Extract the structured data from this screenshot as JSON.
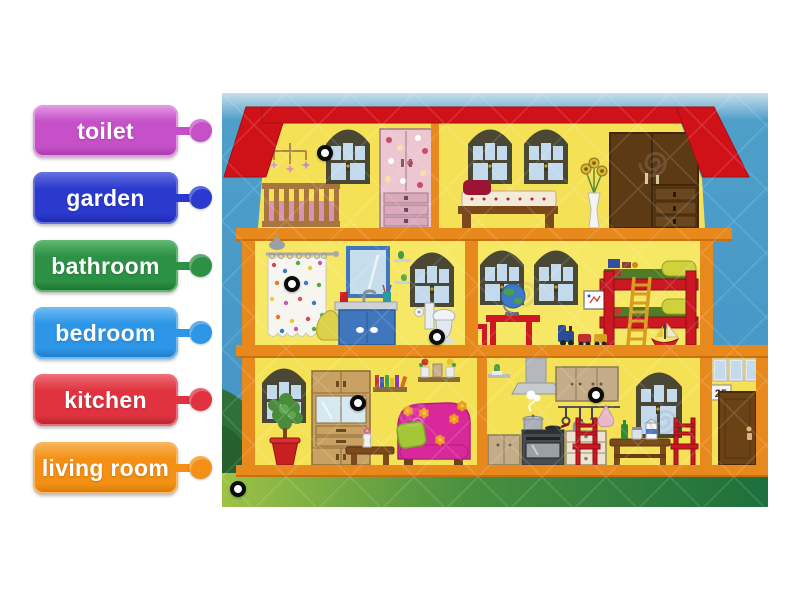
{
  "labels": [
    {
      "text": "toilet",
      "color": "#c650c8",
      "light": "#e39ae4",
      "dark": "#a13ba4"
    },
    {
      "text": "garden",
      "color": "#2a3ace",
      "light": "#6570df",
      "dark": "#1c28a6"
    },
    {
      "text": "bathroom",
      "color": "#2c9144",
      "light": "#5eb871",
      "dark": "#1e6e31"
    },
    {
      "text": "bedroom",
      "color": "#2d96e6",
      "light": "#71bbf2",
      "dark": "#1e78c4"
    },
    {
      "text": "kitchen",
      "color": "#e0333f",
      "light": "#ed6e78",
      "dark": "#b02330"
    },
    {
      "text": "living room",
      "color": "#f39015",
      "light": "#f8b75e",
      "dark": "#d1780b"
    }
  ],
  "house": {
    "door_number": "25"
  },
  "hotspots": [
    {
      "name": "hotspot-nursery",
      "x": 103,
      "y": 60
    },
    {
      "name": "hotspot-shower",
      "x": 70,
      "y": 191
    },
    {
      "name": "hotspot-toilet",
      "x": 215,
      "y": 244
    },
    {
      "name": "hotspot-living-room-cabinet",
      "x": 136,
      "y": 310
    },
    {
      "name": "hotspot-kitchen-cabinet",
      "x": 374,
      "y": 302
    },
    {
      "name": "hotspot-garden",
      "x": 16,
      "y": 396
    }
  ]
}
